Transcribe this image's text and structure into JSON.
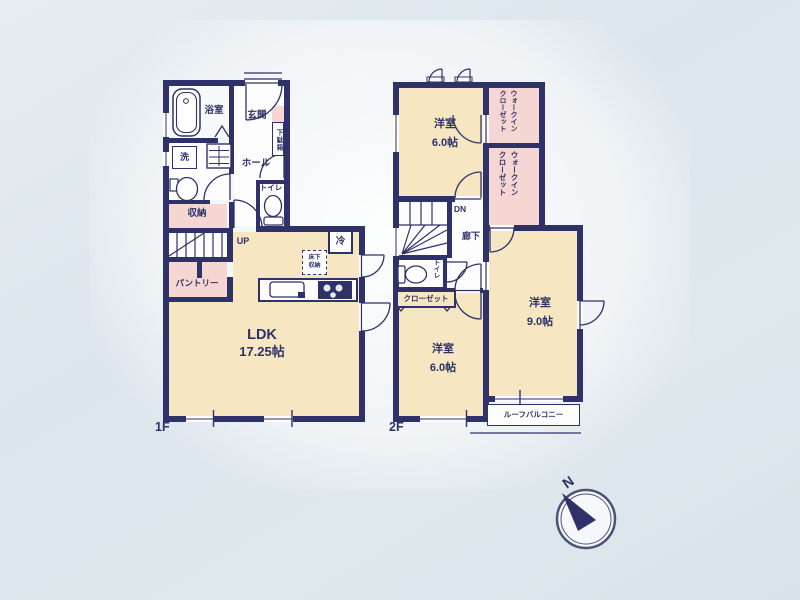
{
  "title": "間取り図",
  "colors": {
    "wall": "#2f3268",
    "room_cream": "#f6e7c2",
    "room_pink": "#f5d6d2",
    "background": "#dbe5ea"
  },
  "floor1": {
    "label": "1F",
    "bath": "浴室",
    "washer": "洗",
    "entrance": "玄関",
    "shoe_cabinet": "下駄箱",
    "hall": "ホール",
    "toilet": "トイレ",
    "storage": "収納",
    "stairs_up": "UP",
    "pantry": "パントリー",
    "fridge": "冷",
    "floor_storage_l1": "床下",
    "floor_storage_l2": "収納",
    "ldk": "LDK",
    "ldk_size": "17.25帖"
  },
  "floor2": {
    "label": "2F",
    "room_top": "洋室",
    "room_top_size": "6.0帖",
    "wic_l1": "ウォークイン",
    "wic_l2": "クローゼット",
    "stairs_dn": "DN",
    "corridor": "廊下",
    "toilet": "トイレ",
    "closet": "クローゼット",
    "room_right": "洋室",
    "room_right_size": "9.0帖",
    "room_bottom": "洋室",
    "room_bottom_size": "6.0帖",
    "balcony": "ルーフバルコニー"
  },
  "compass": {
    "north": "N"
  }
}
